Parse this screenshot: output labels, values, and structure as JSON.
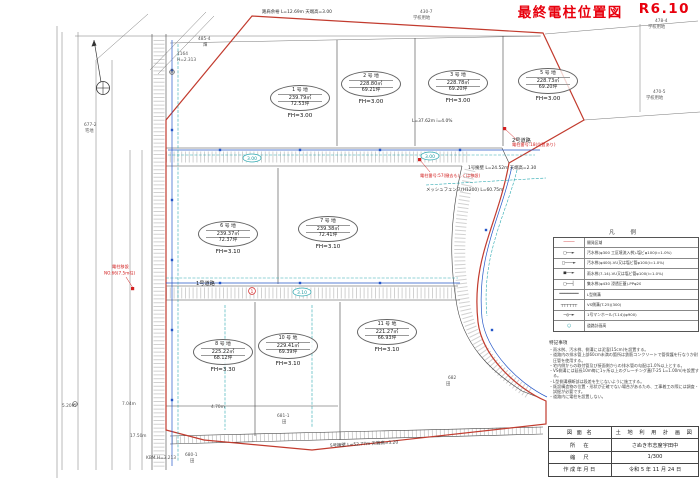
{
  "title": {
    "text": "最終電柱位置図",
    "rev": "R6.10",
    "color": "#e8000d"
  },
  "plots": [
    {
      "name": "1 号 地",
      "area": "239.79㎡",
      "tsubo": "72.53坪",
      "fh": "FH=3.00"
    },
    {
      "name": "2 号 地",
      "area": "228.80㎡",
      "tsubo": "69.21坪",
      "fh": "FH=3.00"
    },
    {
      "name": "3 号 地",
      "area": "228.78㎡",
      "tsubo": "69.20坪",
      "fh": "FH=3.00"
    },
    {
      "name": "5 号 地",
      "area": "228.73㎡",
      "tsubo": "69.20坪",
      "fh": "FH=3.00"
    },
    {
      "name": "6 号 地",
      "area": "239.37㎡",
      "tsubo": "72.37坪",
      "fh": "FH=3.10"
    },
    {
      "name": "7 号 地",
      "area": "239.38㎡",
      "tsubo": "72.41坪",
      "fh": "FH=3.10"
    },
    {
      "name": "8 号 地",
      "area": "225.22㎡",
      "tsubo": "68.12坪",
      "fh": "FH=3.30"
    },
    {
      "name": "10 号 地",
      "area": "229.41㎡",
      "tsubo": "69.39坪",
      "fh": "FH=3.10"
    },
    {
      "name": "11 号 地",
      "area": "221.27㎡",
      "tsubo": "66.93坪",
      "fh": "FH=3.10"
    }
  ],
  "roads": {
    "road1": "1号道路",
    "road2": "2号道路"
  },
  "parcels": [
    {
      "no": "430-7",
      "use": "学校用地"
    },
    {
      "no": "478-4",
      "use": "学校用地"
    },
    {
      "no": "470-5",
      "use": "学校用地"
    },
    {
      "no": "485-4",
      "use": "畑"
    },
    {
      "no": "677-2",
      "use": "宅地"
    },
    {
      "no": "680-1",
      "use": "田"
    },
    {
      "no": "681-1",
      "use": "田"
    },
    {
      "no": "682",
      "use": "田"
    }
  ],
  "structures": {
    "shoulder": "路肩余裕 L=12.69m 天端高=3.00",
    "wall1": "1号擁壁 L=24.52m 天端高=2.30",
    "wall5": "5号擁壁 L=52.77m 天端高=3.20",
    "fence": "メッシュフェンス(H1200) L=60.75m",
    "sewer": "L=37.62m i=4.0%"
  },
  "benchmarks": {
    "bm1_no": "1164",
    "bm1": "H=2.313",
    "bm2": "KBM H=3.213"
  },
  "pole_notes": {
    "n1a": "電柱移設",
    "n1b": "NO.66(7.5m柱)",
    "n2": "電柱番号:57(撤去もしくは移設)",
    "n3": "電柱番号:18(位置あり)",
    "mark1": "1"
  },
  "levels": {
    "l1": "3.00",
    "l2": "3.00",
    "l3": "3.10"
  },
  "dims": {
    "d1": "5.20m",
    "d2": "7.04m",
    "d3": "17.50m",
    "d4": "4.70m"
  },
  "legend": {
    "title": "凡 例",
    "rows": [
      {
        "symbol": "────",
        "label": "開発区域"
      },
      {
        "symbol": "□──►",
        "label": "汚水桝(φ300 工区境流入桝)-塩ビφ100(i=1.0%)"
      },
      {
        "symbol": "□───►",
        "label": "汚水桝(φ400)-VU又は塩ビ管φ100(i=1.0%)"
      },
      {
        "symbol": "■──►",
        "label": "雨水桝(7-14)-VU又は塩ビ管φ100(i=1.0%)"
      },
      {
        "symbol": "□──┤",
        "label": "集水桝(φ430 浸透圧蓋)-PPφ20"
      },
      {
        "symbol": "═══════",
        "label": "L型側溝"
      },
      {
        "symbol": "┬┬┬┬┬┬",
        "label": "VS側溝(T-25)(300)"
      },
      {
        "symbol": "─◎─►",
        "label": "1号マンホール(T-14)(φ900)"
      },
      {
        "symbol": "◯",
        "label": "道路計画高"
      }
    ]
  },
  "notes": {
    "title": "特記事項",
    "items": [
      "・雨水桝、汚水桝、側溝には泥溜(15cm)を設置する。",
      "・道路内の排水管上部60cm未満の箇所は鉄筋コンクリートで管保護を行なうか耐圧管を使用する。",
      "・宅内側からの取付管及び接面側からの排水管の勾配は1.0%以上とする。",
      "・VS側溝には延長10m毎に1ヶ所以上のグレーチング蓋(T-25 L=1.00m)を設置する。",
      "・L型側溝横断部は段差を生じないように施工する。",
      "・既設構造物の位置・形状が正確でない場合があるため、工事着工の際には調査・試掘が必要です。",
      "・道路内に電柱を設置しない。"
    ]
  },
  "title_block": {
    "rows": [
      {
        "label": "図 面 名",
        "value": "土 地 利 用 計 画 図"
      },
      {
        "label": "所　在",
        "value": "さぬき市志度宇田中"
      },
      {
        "label": "縮　尺",
        "value": "1/300"
      },
      {
        "label": "作成年月日",
        "value": "令和 5 年 11 月 24 日"
      }
    ]
  }
}
